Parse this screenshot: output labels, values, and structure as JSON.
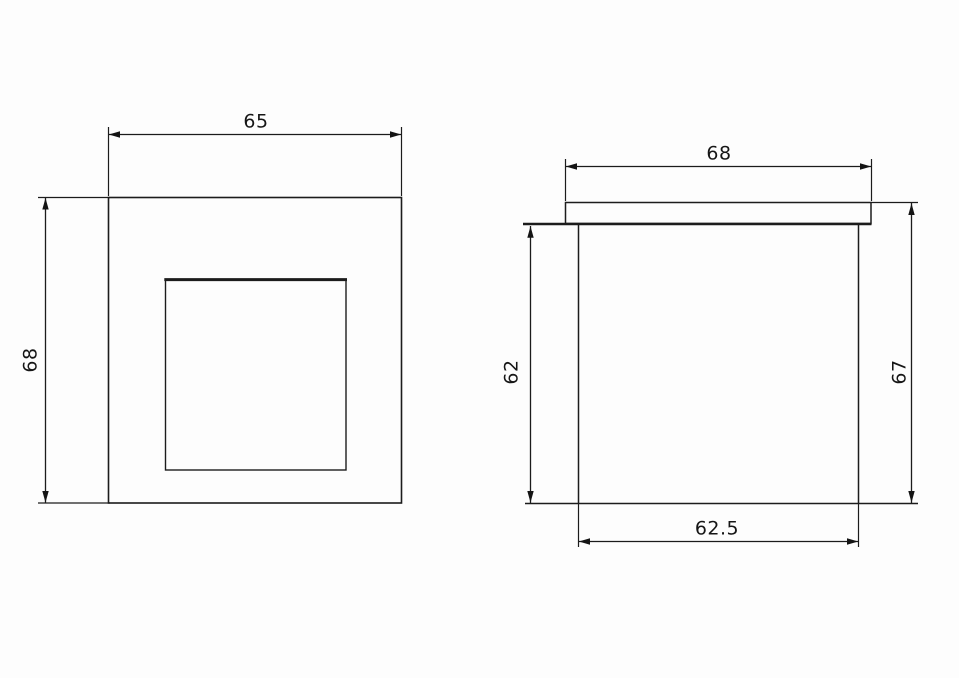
{
  "page": {
    "background": "#fdfdfd",
    "line_color": "#1c1c1c",
    "text_color": "#161616"
  },
  "drawing": {
    "type": "technical-dimension-drawing",
    "views": {
      "front": {
        "title": "front-view-square-plate-with-inner-opening",
        "dimensions": {
          "top_width": "65",
          "left_height": "68"
        }
      },
      "side": {
        "title": "side-view-body-with-top-flange",
        "dimensions": {
          "top_width": "68",
          "left_height": "62",
          "right_height": "67",
          "bottom_width": "62.5"
        }
      }
    }
  }
}
